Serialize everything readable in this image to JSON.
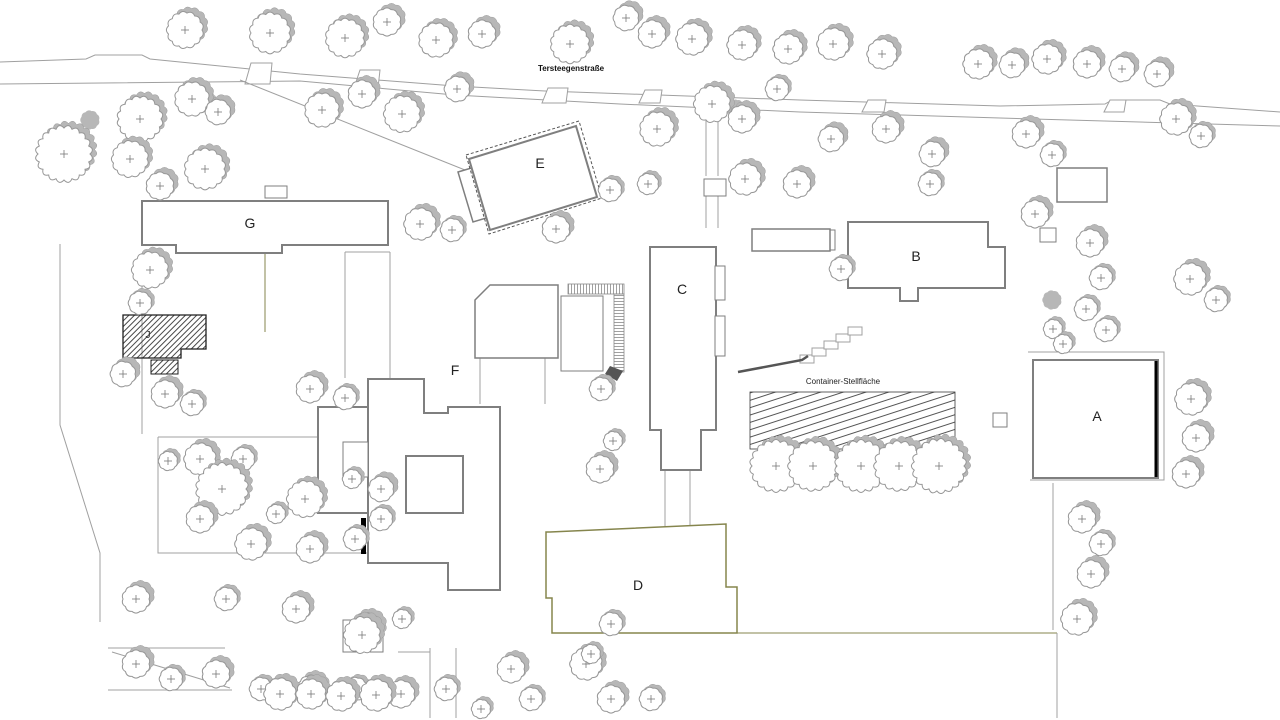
{
  "labels": {
    "street_name": "Tersteegenstraße",
    "container_area": "Container-Stellfläche"
  },
  "colors": {
    "outline": "#7f7f7f",
    "thin": "#a0a0a0",
    "olive": "#85854d",
    "tree_stroke": "#979797",
    "tree_shadow": "#b7b7b7",
    "label": "#222222",
    "dark": "#555555",
    "hatch_edge": "#1f1f1f"
  },
  "street": {
    "label_pos": [
      571,
      71
    ],
    "top": [
      [
        0,
        62
      ],
      [
        86,
        59
      ],
      [
        95,
        55
      ],
      [
        142,
        55
      ],
      [
        150,
        59
      ],
      [
        300,
        74
      ],
      [
        455,
        86
      ],
      [
        545,
        91
      ],
      [
        800,
        100
      ],
      [
        1000,
        106
      ],
      [
        1105,
        104
      ],
      [
        1112,
        100
      ],
      [
        1160,
        100
      ],
      [
        1170,
        104
      ],
      [
        1280,
        112
      ]
    ],
    "bottom": [
      [
        0,
        84
      ],
      [
        300,
        81
      ],
      [
        455,
        95
      ],
      [
        620,
        104
      ],
      [
        800,
        112
      ],
      [
        1000,
        118
      ],
      [
        1280,
        126
      ]
    ],
    "driveways": [
      [
        243,
        63,
        272,
        84
      ],
      [
        352,
        70,
        380,
        88
      ],
      [
        540,
        88,
        568,
        103
      ],
      [
        637,
        90,
        662,
        103
      ],
      [
        860,
        100,
        886,
        112
      ],
      [
        1102,
        100,
        1126,
        112
      ]
    ]
  },
  "building_labels": [
    {
      "id": "A",
      "text": "A",
      "x": 1097,
      "y": 421,
      "size": 14
    },
    {
      "id": "B",
      "text": "B",
      "x": 916,
      "y": 261,
      "size": 14
    },
    {
      "id": "C",
      "text": "C",
      "x": 682,
      "y": 294,
      "size": 14
    },
    {
      "id": "D",
      "text": "D",
      "x": 638,
      "y": 590,
      "size": 14
    },
    {
      "id": "E",
      "text": "E",
      "x": 540,
      "y": 168,
      "size": 14
    },
    {
      "id": "F",
      "text": "F",
      "x": 455,
      "y": 375,
      "size": 14
    },
    {
      "id": "G",
      "text": "G",
      "x": 250,
      "y": 228,
      "size": 14
    },
    {
      "id": "J",
      "text": "J",
      "x": 148,
      "y": 338,
      "size": 10
    }
  ],
  "building_polys": [
    {
      "id": "G",
      "w": 2,
      "pts": [
        [
          142,
          201
        ],
        [
          388,
          201
        ],
        [
          388,
          245
        ],
        [
          282,
          245
        ],
        [
          282,
          253
        ],
        [
          176,
          253
        ],
        [
          176,
          245
        ],
        [
          142,
          245
        ]
      ]
    },
    {
      "id": "C",
      "w": 2,
      "pts": [
        [
          650,
          247
        ],
        [
          716,
          247
        ],
        [
          716,
          430
        ],
        [
          701,
          430
        ],
        [
          701,
          470
        ],
        [
          661,
          470
        ],
        [
          661,
          430
        ],
        [
          650,
          430
        ]
      ]
    },
    {
      "id": "B",
      "w": 2,
      "pts": [
        [
          848,
          222
        ],
        [
          988,
          222
        ],
        [
          988,
          247
        ],
        [
          1005,
          247
        ],
        [
          1005,
          288
        ],
        [
          918,
          288
        ],
        [
          918,
          301
        ],
        [
          900,
          301
        ],
        [
          900,
          288
        ],
        [
          848,
          288
        ]
      ]
    },
    {
      "id": "A",
      "w": 2,
      "pts": [
        [
          1033,
          360
        ],
        [
          1158,
          360
        ],
        [
          1158,
          478
        ],
        [
          1033,
          478
        ]
      ]
    },
    {
      "id": "D",
      "w": 1.5,
      "s": "olive",
      "pts": [
        [
          550,
          532
        ],
        [
          726,
          524
        ],
        [
          726,
          587
        ],
        [
          737,
          587
        ],
        [
          737,
          633
        ],
        [
          552,
          633
        ],
        [
          552,
          598
        ],
        [
          546,
          598
        ],
        [
          546,
          532
        ]
      ]
    },
    {
      "id": "F",
      "w": 2,
      "pts": [
        [
          368,
          379
        ],
        [
          424,
          379
        ],
        [
          424,
          413
        ],
        [
          448,
          413
        ],
        [
          448,
          407
        ],
        [
          500,
          407
        ],
        [
          500,
          590
        ],
        [
          448,
          590
        ],
        [
          448,
          563
        ],
        [
          368,
          563
        ]
      ]
    },
    {
      "id": "F-west-wing",
      "w": 2,
      "pts": [
        [
          318,
          407
        ],
        [
          368,
          407
        ],
        [
          368,
          513
        ],
        [
          318,
          513
        ]
      ]
    },
    {
      "id": "conservatory",
      "w": 1.5,
      "pts": [
        [
          475,
          300
        ],
        [
          490,
          285
        ],
        [
          558,
          285
        ],
        [
          558,
          358
        ],
        [
          475,
          358
        ]
      ]
    }
  ],
  "e_complex": {
    "annex": [
      [
        458,
        172
      ],
      [
        508,
        157
      ],
      [
        523,
        207
      ],
      [
        473,
        222
      ]
    ],
    "main": [
      [
        469,
        159
      ],
      [
        576,
        126
      ],
      [
        597,
        197
      ],
      [
        490,
        230
      ]
    ],
    "dashed": [
      [
        466,
        155
      ],
      [
        579,
        121
      ],
      [
        602,
        198
      ],
      [
        489,
        234
      ]
    ]
  },
  "structures": [
    [
      1057,
      168,
      50,
      34,
      1.5
    ],
    [
      1040,
      228,
      16,
      14,
      1
    ],
    [
      815,
      230,
      20,
      20,
      1
    ],
    [
      752,
      229,
      78,
      22,
      1.5
    ],
    [
      704,
      179,
      22,
      17,
      1
    ],
    [
      993,
      413,
      14,
      14,
      1
    ],
    [
      715,
      266,
      10,
      34,
      1
    ],
    [
      715,
      316,
      10,
      40,
      1
    ],
    [
      343,
      620,
      40,
      32,
      1
    ],
    [
      265,
      186,
      22,
      12,
      1
    ],
    [
      343,
      442,
      25,
      35,
      1
    ],
    [
      406,
      456,
      57,
      57,
      2
    ],
    [
      561,
      296,
      42,
      75,
      1
    ]
  ],
  "hatched": {
    "j_main": [
      [
        123,
        315
      ],
      [
        206,
        315
      ],
      [
        206,
        349
      ],
      [
        181,
        349
      ],
      [
        181,
        358
      ],
      [
        123,
        358
      ]
    ],
    "j_small": [
      151,
      360,
      27,
      14
    ],
    "container": [
      750,
      392,
      205,
      57
    ],
    "container_label_pos": [
      843,
      384
    ]
  },
  "ramp": {
    "h_band": [
      568,
      284,
      56,
      10
    ],
    "v_band": [
      614,
      294,
      10,
      78
    ],
    "tip": [
      [
        610,
        366
      ],
      [
        623,
        371
      ],
      [
        617,
        381
      ],
      [
        605,
        374
      ]
    ]
  },
  "steps": {
    "rects": [
      [
        800,
        355
      ],
      [
        812,
        348
      ],
      [
        824,
        341
      ],
      [
        836,
        334
      ],
      [
        848,
        327
      ]
    ],
    "rect_w": 14,
    "rect_h": 8,
    "railing": [
      [
        738,
        372
      ],
      [
        802,
        360
      ],
      [
        808,
        356
      ]
    ]
  },
  "planters": {
    "row": [
      [
        758,
        459,
        36,
        15
      ],
      [
        797,
        459,
        31,
        15
      ],
      [
        846,
        459,
        31,
        15
      ],
      [
        884,
        459,
        31,
        15
      ],
      [
        922,
        459,
        35,
        15
      ]
    ],
    "squares": [
      [
        274,
        688,
        12,
        12
      ],
      [
        305,
        688,
        12,
        12
      ],
      [
        335,
        690,
        12,
        12
      ],
      [
        370,
        689,
        12,
        12
      ]
    ]
  },
  "paths": [
    {
      "c": "thin",
      "pts": [
        [
          706,
          98
        ],
        [
          706,
          176
        ]
      ]
    },
    {
      "c": "thin",
      "pts": [
        [
          718,
          98
        ],
        [
          718,
          176
        ]
      ]
    },
    {
      "c": "thin",
      "pts": [
        [
          706,
          196
        ],
        [
          706,
          228
        ]
      ]
    },
    {
      "c": "thin",
      "pts": [
        [
          718,
          196
        ],
        [
          718,
          228
        ]
      ]
    },
    {
      "c": "thin",
      "pts": [
        [
          240,
          80
        ],
        [
          470,
          172
        ]
      ]
    },
    {
      "c": "thin",
      "pts": [
        [
          60,
          244
        ],
        [
          60,
          425
        ],
        [
          100,
          553
        ],
        [
          100,
          622
        ]
      ]
    },
    {
      "c": "thin",
      "pts": [
        [
          158,
          437
        ],
        [
          425,
          437
        ],
        [
          425,
          553
        ],
        [
          158,
          553
        ],
        [
          158,
          437
        ]
      ]
    },
    {
      "c": "olive",
      "pts": [
        [
          737,
          633
        ],
        [
          1057,
          633
        ]
      ]
    },
    {
      "c": "thin",
      "pts": [
        [
          1057,
          633
        ],
        [
          1057,
          718
        ]
      ]
    },
    {
      "c": "thin",
      "pts": [
        [
          1053,
          483
        ],
        [
          1053,
          630
        ]
      ]
    },
    {
      "c": "thin",
      "pts": [
        [
          1028,
          352
        ],
        [
          1164,
          352
        ],
        [
          1164,
          480
        ],
        [
          1030,
          480
        ]
      ]
    },
    {
      "c": "olive",
      "pts": [
        [
          265,
          245
        ],
        [
          265,
          332
        ]
      ]
    },
    {
      "c": "thin",
      "pts": [
        [
          345,
          252
        ],
        [
          345,
          378
        ]
      ]
    },
    {
      "c": "thin",
      "pts": [
        [
          390,
          252
        ],
        [
          390,
          378
        ]
      ]
    },
    {
      "c": "thin",
      "pts": [
        [
          345,
          252
        ],
        [
          390,
          252
        ]
      ]
    },
    {
      "c": "thin",
      "pts": [
        [
          142,
          253
        ],
        [
          142,
          434
        ]
      ]
    },
    {
      "c": "thin",
      "pts": [
        [
          665,
          470
        ],
        [
          665,
          528
        ]
      ]
    },
    {
      "c": "thin",
      "pts": [
        [
          690,
          470
        ],
        [
          690,
          528
        ]
      ]
    },
    {
      "c": "thin",
      "pts": [
        [
          430,
          648
        ],
        [
          430,
          718
        ]
      ]
    },
    {
      "c": "thin",
      "pts": [
        [
          456,
          648
        ],
        [
          456,
          718
        ]
      ]
    },
    {
      "c": "thin",
      "pts": [
        [
          398,
          652
        ],
        [
          430,
          652
        ]
      ]
    },
    {
      "c": "thin",
      "pts": [
        [
          108,
          648
        ],
        [
          225,
          648
        ]
      ]
    },
    {
      "c": "thin",
      "pts": [
        [
          108,
          690
        ],
        [
          232,
          690
        ]
      ]
    },
    {
      "c": "thin",
      "pts": [
        [
          112,
          652
        ],
        [
          230,
          688
        ]
      ]
    },
    {
      "c": "thin",
      "pts": [
        [
          480,
          358
        ],
        [
          480,
          404
        ]
      ]
    },
    {
      "c": "thin",
      "pts": [
        [
          545,
          358
        ],
        [
          545,
          404
        ]
      ]
    },
    {
      "c": "thin",
      "pts": [
        [
          475,
          320
        ],
        [
          558,
          320
        ]
      ]
    },
    {
      "c": "thin",
      "pts": [
        [
          516,
          285
        ],
        [
          516,
          358
        ]
      ]
    }
  ],
  "door_marks": [
    [
      361,
      518,
      5,
      36
    ]
  ],
  "thick_edges": [
    [
      1156,
      361,
      1156,
      477
    ]
  ],
  "bushes": [
    [
      1052,
      300,
      9
    ],
    [
      736,
      108,
      8
    ],
    [
      714,
      95,
      7
    ],
    [
      208,
      100,
      8
    ],
    [
      90,
      120,
      9
    ]
  ],
  "trees": [
    [
      185,
      30,
      17
    ],
    [
      270,
      33,
      19
    ],
    [
      345,
      38,
      18
    ],
    [
      387,
      22,
      13
    ],
    [
      436,
      40,
      16
    ],
    [
      482,
      34,
      13
    ],
    [
      570,
      44,
      18
    ],
    [
      626,
      18,
      12
    ],
    [
      652,
      34,
      13
    ],
    [
      692,
      39,
      15
    ],
    [
      742,
      45,
      14
    ],
    [
      788,
      49,
      14
    ],
    [
      833,
      44,
      15
    ],
    [
      882,
      54,
      14
    ],
    [
      978,
      64,
      14
    ],
    [
      1012,
      65,
      12
    ],
    [
      1047,
      59,
      14
    ],
    [
      1087,
      64,
      13
    ],
    [
      1122,
      69,
      12
    ],
    [
      1157,
      74,
      12
    ],
    [
      140,
      119,
      21
    ],
    [
      192,
      99,
      16
    ],
    [
      218,
      112,
      12
    ],
    [
      322,
      110,
      16
    ],
    [
      362,
      94,
      13
    ],
    [
      402,
      114,
      17
    ],
    [
      457,
      89,
      12
    ],
    [
      657,
      129,
      16
    ],
    [
      712,
      104,
      17
    ],
    [
      742,
      119,
      13
    ],
    [
      777,
      89,
      11
    ],
    [
      831,
      139,
      12
    ],
    [
      886,
      129,
      13
    ],
    [
      932,
      154,
      12
    ],
    [
      1026,
      134,
      13
    ],
    [
      1052,
      155,
      11
    ],
    [
      1176,
      119,
      15
    ],
    [
      1201,
      136,
      11
    ],
    [
      64,
      154,
      26
    ],
    [
      130,
      159,
      17
    ],
    [
      205,
      169,
      19
    ],
    [
      160,
      186,
      13
    ],
    [
      150,
      270,
      17
    ],
    [
      140,
      303,
      11
    ],
    [
      420,
      224,
      15
    ],
    [
      452,
      230,
      11
    ],
    [
      556,
      229,
      13
    ],
    [
      610,
      190,
      11
    ],
    [
      648,
      184,
      10
    ],
    [
      745,
      179,
      15
    ],
    [
      797,
      184,
      13
    ],
    [
      841,
      269,
      11
    ],
    [
      930,
      184,
      11
    ],
    [
      1035,
      214,
      13
    ],
    [
      1090,
      243,
      13
    ],
    [
      1101,
      278,
      11
    ],
    [
      1086,
      309,
      11
    ],
    [
      1106,
      330,
      11
    ],
    [
      1190,
      279,
      15
    ],
    [
      1216,
      300,
      11
    ],
    [
      1053,
      329,
      9
    ],
    [
      1063,
      344,
      9
    ],
    [
      1191,
      399,
      15
    ],
    [
      1196,
      438,
      13
    ],
    [
      1186,
      474,
      13
    ],
    [
      1082,
      519,
      13
    ],
    [
      1101,
      544,
      11
    ],
    [
      1091,
      574,
      13
    ],
    [
      1077,
      619,
      15
    ],
    [
      123,
      374,
      12
    ],
    [
      165,
      394,
      13
    ],
    [
      192,
      404,
      11
    ],
    [
      310,
      389,
      13
    ],
    [
      345,
      398,
      11
    ],
    [
      200,
      459,
      15
    ],
    [
      243,
      459,
      11
    ],
    [
      222,
      489,
      24
    ],
    [
      305,
      499,
      17
    ],
    [
      352,
      479,
      9
    ],
    [
      381,
      489,
      12
    ],
    [
      200,
      519,
      13
    ],
    [
      251,
      544,
      15
    ],
    [
      310,
      549,
      13
    ],
    [
      355,
      539,
      11
    ],
    [
      381,
      519,
      11
    ],
    [
      276,
      514,
      9
    ],
    [
      168,
      461,
      9
    ],
    [
      601,
      389,
      11
    ],
    [
      600,
      469,
      13
    ],
    [
      613,
      441,
      9
    ],
    [
      136,
      599,
      13
    ],
    [
      226,
      599,
      11
    ],
    [
      296,
      609,
      13
    ],
    [
      366,
      629,
      15
    ],
    [
      402,
      619,
      9
    ],
    [
      136,
      664,
      13
    ],
    [
      171,
      679,
      11
    ],
    [
      216,
      674,
      13
    ],
    [
      261,
      689,
      11
    ],
    [
      311,
      689,
      13
    ],
    [
      356,
      689,
      11
    ],
    [
      401,
      694,
      13
    ],
    [
      446,
      689,
      11
    ],
    [
      511,
      669,
      13
    ],
    [
      586,
      664,
      15
    ],
    [
      611,
      699,
      13
    ],
    [
      531,
      699,
      11
    ],
    [
      481,
      709,
      9
    ],
    [
      611,
      624,
      11
    ],
    [
      591,
      654,
      9
    ],
    [
      651,
      699,
      11
    ],
    [
      362,
      635,
      17
    ],
    [
      776,
      466,
      24
    ],
    [
      813,
      466,
      23
    ],
    [
      861,
      466,
      24
    ],
    [
      899,
      466,
      23
    ],
    [
      939,
      466,
      25
    ],
    [
      280,
      694,
      15
    ],
    [
      311,
      694,
      14
    ],
    [
      341,
      696,
      14
    ],
    [
      376,
      695,
      15
    ]
  ]
}
